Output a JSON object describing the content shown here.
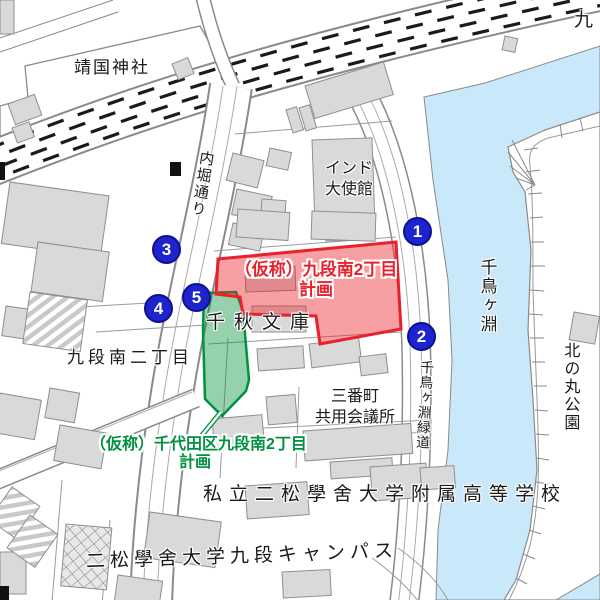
{
  "map": {
    "labels": {
      "yasukuni_shrine": "靖国神社",
      "kudan_partial": "九",
      "uchibori_dori": "内堀通り",
      "india_embassy_line1": "インド",
      "india_embassy_line2": "大使館",
      "chiaki_bunko": "千秋文庫",
      "kudanminami_2chome": "九段南二丁目",
      "sanbancho_line1": "三番町",
      "sanbancho_line2": "共用会議所",
      "chidorigafuchi": "千鳥ヶ淵",
      "chidorigafuchi_ryokudo": "千鳥ヶ淵緑道",
      "kitanomaru_park": "北の丸公園",
      "private_high_school": "私立二松學舍大学附属高等学校",
      "nishogakusha_campus": "二松學舍大学九段キャンパス"
    },
    "projects": {
      "red": {
        "line1": "（仮称）九段南2丁目",
        "line2": "計画",
        "color": "#e8212d"
      },
      "green": {
        "line1": "（仮称）千代田区九段南2丁目",
        "line2": "計画",
        "color": "#009140"
      }
    },
    "markers": [
      {
        "label": "1"
      },
      {
        "label": "2"
      },
      {
        "label": "3"
      },
      {
        "label": "4"
      },
      {
        "label": "5"
      }
    ],
    "colors": {
      "water": "#c9e8fa",
      "building": "#d9d9d9",
      "building_outline": "#8f8f8f",
      "marker_blue": "#1d23cd",
      "road_dash": "#1a1a1a",
      "red_area_fill": "#ed1c24",
      "green_area_fill": "#00913a"
    }
  }
}
